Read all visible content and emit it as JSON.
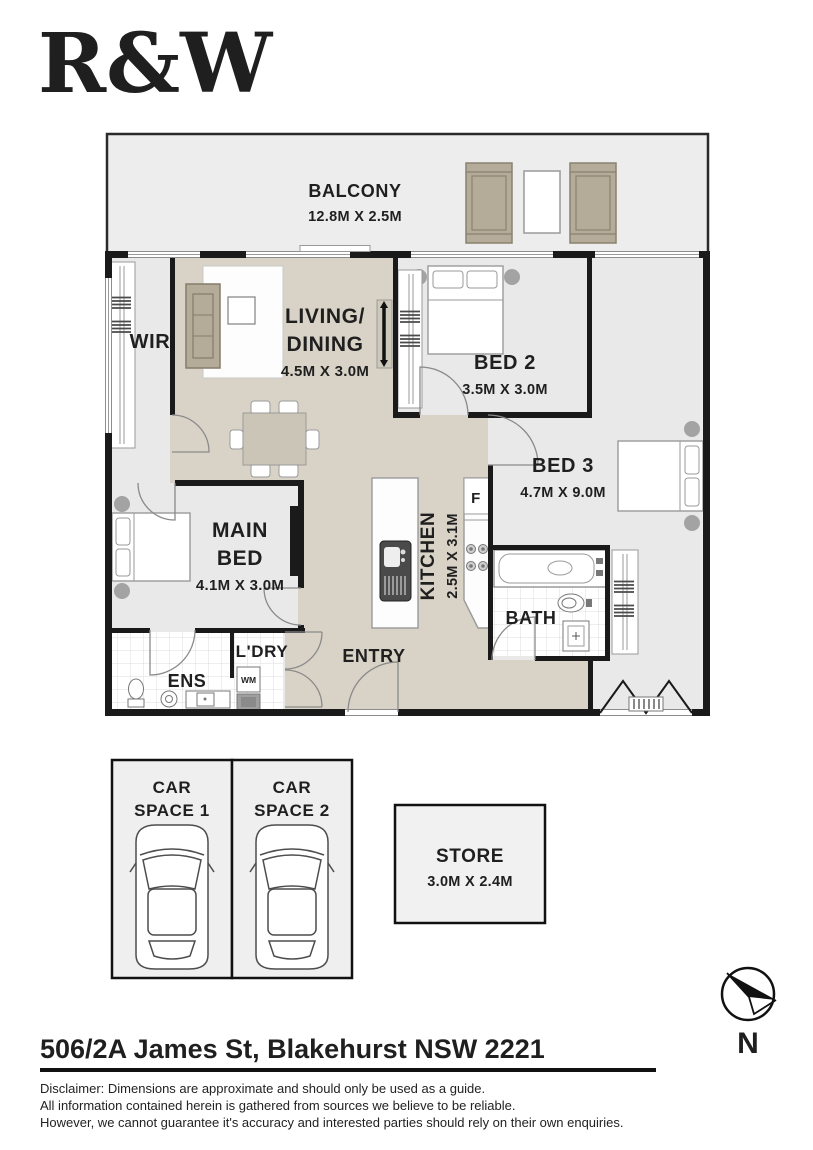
{
  "brand": {
    "logo_text": "R&W",
    "color": "#e51c2f"
  },
  "plan": {
    "balcony": {
      "label": "BALCONY",
      "dims": "12.8M X 2.5M"
    },
    "wir": {
      "label": "WIR"
    },
    "living": {
      "line1": "LIVING/",
      "line2": "DINING",
      "dims": "4.5M X 3.0M"
    },
    "bed2": {
      "label": "BED 2",
      "dims": "3.5M X 3.0M"
    },
    "bed3": {
      "label": "BED 3",
      "dims": "4.7M X 9.0M"
    },
    "main_bed": {
      "line1": "MAIN",
      "line2": "BED",
      "dims": "4.1M X 3.0M"
    },
    "kitchen": {
      "label": "KITCHEN",
      "dims": "2.5M X 3.1M"
    },
    "fridge": {
      "label": "F"
    },
    "bath": {
      "label": "BATH"
    },
    "ens": {
      "label": "ENS"
    },
    "ldry": {
      "label": "L'DRY"
    },
    "wm": {
      "label": "WM"
    },
    "entry": {
      "label": "ENTRY"
    }
  },
  "parking": {
    "space1_line1": "CAR",
    "space1_line2": "SPACE 1",
    "space2_line1": "CAR",
    "space2_line2": "SPACE 2"
  },
  "store": {
    "label": "STORE",
    "dims": "3.0M X 2.4M"
  },
  "compass": {
    "label": "N"
  },
  "footer": {
    "address": "506/2A James St, Blakehurst NSW 2221",
    "disclaimer": [
      "Disclaimer: Dimensions are approximate and should only be used as a guide.",
      "All information contained herein is gathered from sources we believe to be reliable.",
      "However, we cannot guarantee it's accuracy and interested parties should rely on their own enquiries."
    ]
  },
  "colors": {
    "wall": "#1a1a1a",
    "room_gray": "#e9e9e9",
    "floor_beige": "#d9d3c7",
    "tan": "#b5ab99"
  }
}
